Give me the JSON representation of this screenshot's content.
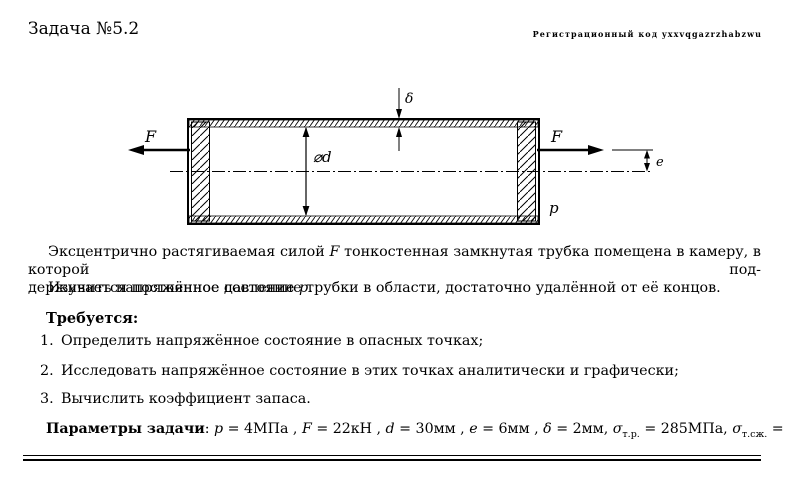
{
  "header": {
    "title": "Задача №5.2",
    "registration": "Регистрационный код yxxvqgazrzhabzwu"
  },
  "diagram": {
    "labels": {
      "force_left": "F",
      "force_right": "F",
      "wall_thickness": "δ",
      "diameter": "⌀d",
      "eccentricity": "e",
      "pressure": "p"
    }
  },
  "intro": {
    "l1_pre": "Эксцентрично растягиваемая силой ",
    "l1_var": "F",
    "l1_post": " тонкостенная замкнутая трубка помещена в камеру, в которой под-",
    "l2_pre": "держивается постоянное давление ",
    "l2_var": "p",
    "l2_post": ".",
    "study": "Изучить напряжённое состояние трубки в области, достаточно удалённой от её концов."
  },
  "tasks": {
    "heading": "Требуется:",
    "items": [
      {
        "number": "1.",
        "text": "Определить напряжённое состояние в опасных точках;"
      },
      {
        "number": "2.",
        "text": "Исследовать напряжённое состояние в этих точках аналитически и графически;"
      },
      {
        "number": "3.",
        "text": "Вычислить коэффициент запаса."
      }
    ]
  },
  "parameters": {
    "label": "Параметры задачи",
    "sep": ": ",
    "p": {
      "var": "p",
      "eq": " = 4МПа , "
    },
    "F": {
      "var": "F",
      "eq": " = 22кН , "
    },
    "d": {
      "var": "d",
      "eq": " = 30мм , "
    },
    "e": {
      "var": "e",
      "eq": " = 6мм , "
    },
    "delta": {
      "var": "δ",
      "eq": " = 2мм, "
    },
    "sigma_t": {
      "var": "σ",
      "sub": "т.р.",
      "eq": " = 285МПа, "
    },
    "sigma_c": {
      "var": "σ",
      "sub": "т.сж.",
      "eq": " = 320МПа."
    }
  }
}
